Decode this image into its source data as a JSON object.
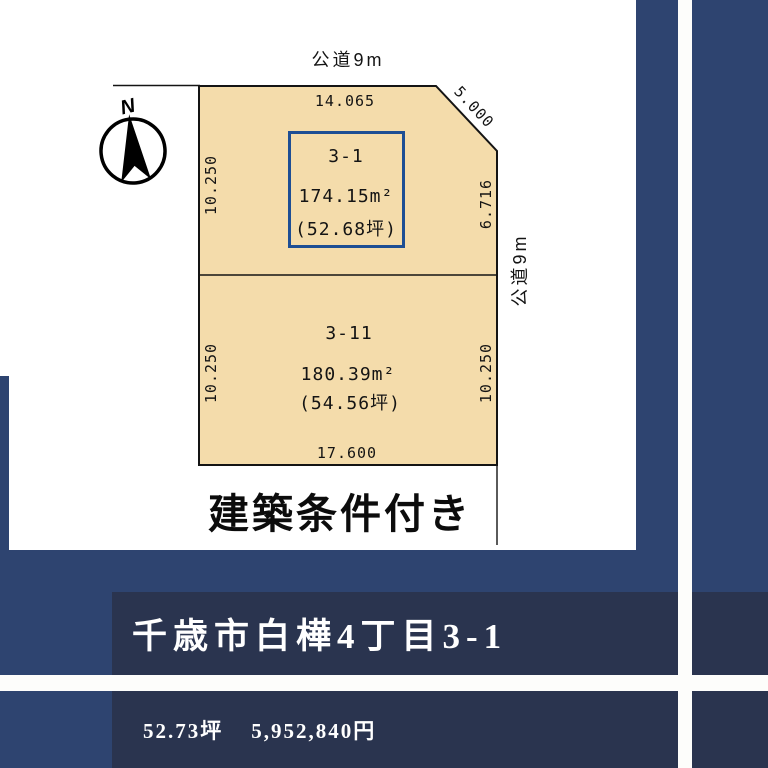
{
  "colors": {
    "frame_navy": "#2e4470",
    "panel_navy": "#2a344f",
    "lot_fill": "#f4dcab",
    "highlight_box_blue": "#1d4e94",
    "text_black": "#141414",
    "banner_text_white": "#ffffff"
  },
  "compass": {
    "label": "N"
  },
  "diagram": {
    "road_top_label": "公道9m",
    "road_right_label": "公道9m",
    "caption": "建築条件付き",
    "dims": {
      "top": "14.065",
      "chamfer": "5.000",
      "left_upper": "10.250",
      "right_upper": "6.716",
      "left_lower": "10.250",
      "right_lower": "10.250",
      "bottom": "17.600"
    },
    "lots": [
      {
        "number": "3-1",
        "area_m2": "174.15m²",
        "area_tsubo": "(52.68坪)"
      },
      {
        "number": "3-11",
        "area_m2": "180.39m²",
        "area_tsubo": "(54.56坪)"
      }
    ]
  },
  "banner": {
    "address": "千歳市白樺4丁目3-1",
    "price_tsubo": "52.73坪",
    "price_yen": "5,952,840円"
  }
}
